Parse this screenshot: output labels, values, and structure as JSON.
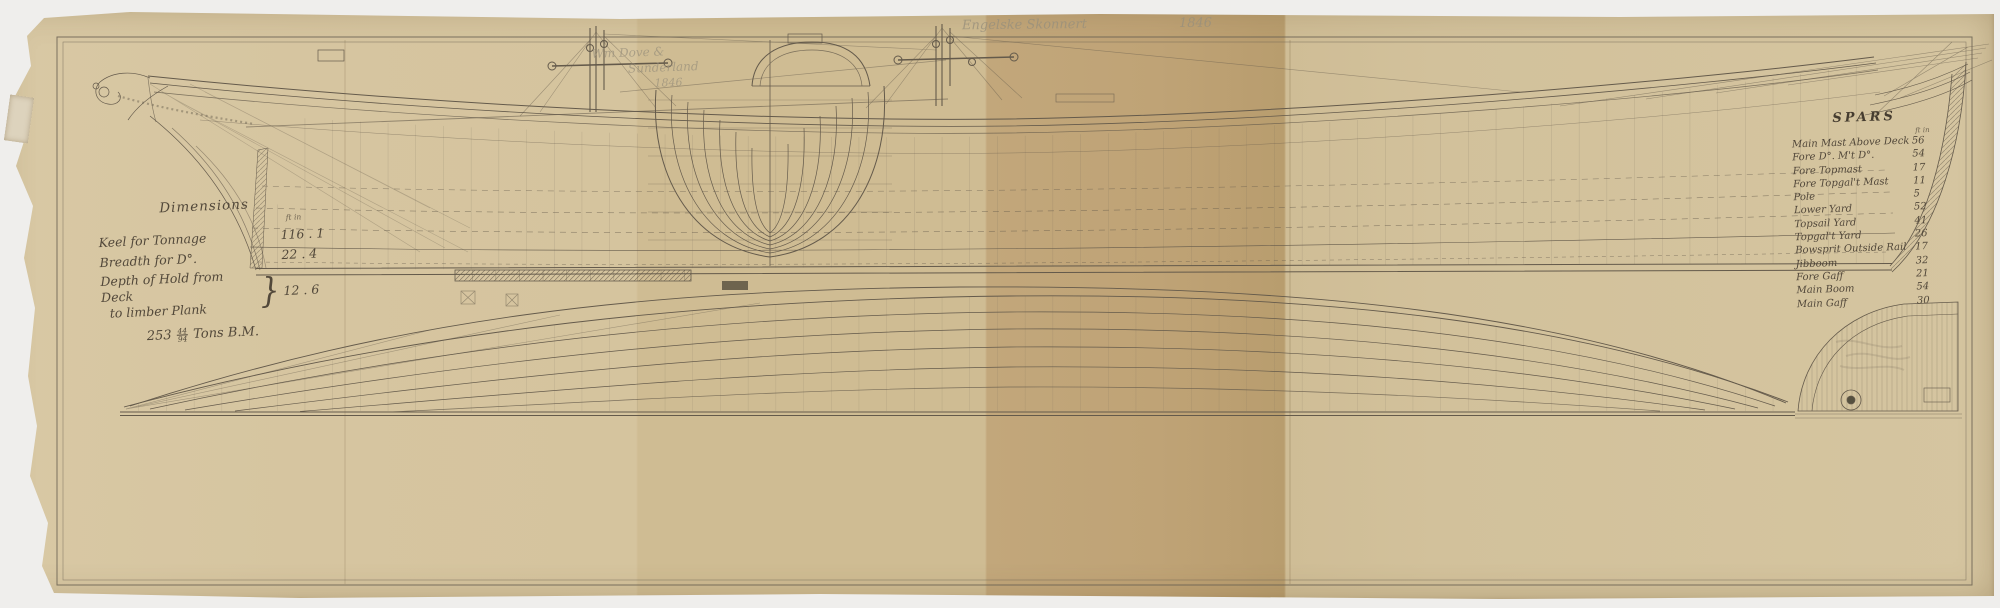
{
  "pencil": {
    "title": "Engelske Skonnert",
    "year": "1846"
  },
  "builder": {
    "line1": "Wm Dove &",
    "line2": "Sunderland",
    "line3": "1846"
  },
  "dimensions": {
    "title": "Dimensions",
    "unit_header": "ft   in",
    "rows": [
      {
        "label": "Keel for Tonnage",
        "value": "116 . 1"
      },
      {
        "label": "Breadth for D°.",
        "value": "22 . 4"
      }
    ],
    "depth": {
      "line1": "Depth of Hold from Deck",
      "line2": "to limber Plank",
      "value": "12 . 6"
    },
    "tonnage": {
      "whole": "253",
      "num": "44",
      "den": "94",
      "suffix": "Tons B.M."
    }
  },
  "spars": {
    "title": "SPARS",
    "unit_header": "ft  in",
    "rows": [
      {
        "name": "Main Mast Above Deck",
        "value": "56"
      },
      {
        "name": "Fore D°. M't D°.",
        "value": "54"
      },
      {
        "name": "Fore Topmast",
        "value": "17"
      },
      {
        "name": "Fore Topgal't Mast",
        "value": "11"
      },
      {
        "name": "Pole",
        "value": "5"
      },
      {
        "name": "Lower Yard",
        "value": "52"
      },
      {
        "name": "Topsail Yard",
        "value": "41"
      },
      {
        "name": "Topgal't Yard",
        "value": "26"
      },
      {
        "name": "Bowsprit Outside Rail",
        "value": "17"
      },
      {
        "name": "Jibboom",
        "value": "32"
      },
      {
        "name": "Fore Gaff",
        "value": "21"
      },
      {
        "name": "Main Boom",
        "value": "54"
      },
      {
        "name": "Main Gaff",
        "value": "30"
      }
    ]
  },
  "colors": {
    "scan_bg": "#efeeec",
    "paper_light": "#d7c7a2",
    "paper_dark": "#b89d6e",
    "ink": "#645a4b",
    "pencil": "#99907c",
    "text_ink": "#52483a"
  }
}
